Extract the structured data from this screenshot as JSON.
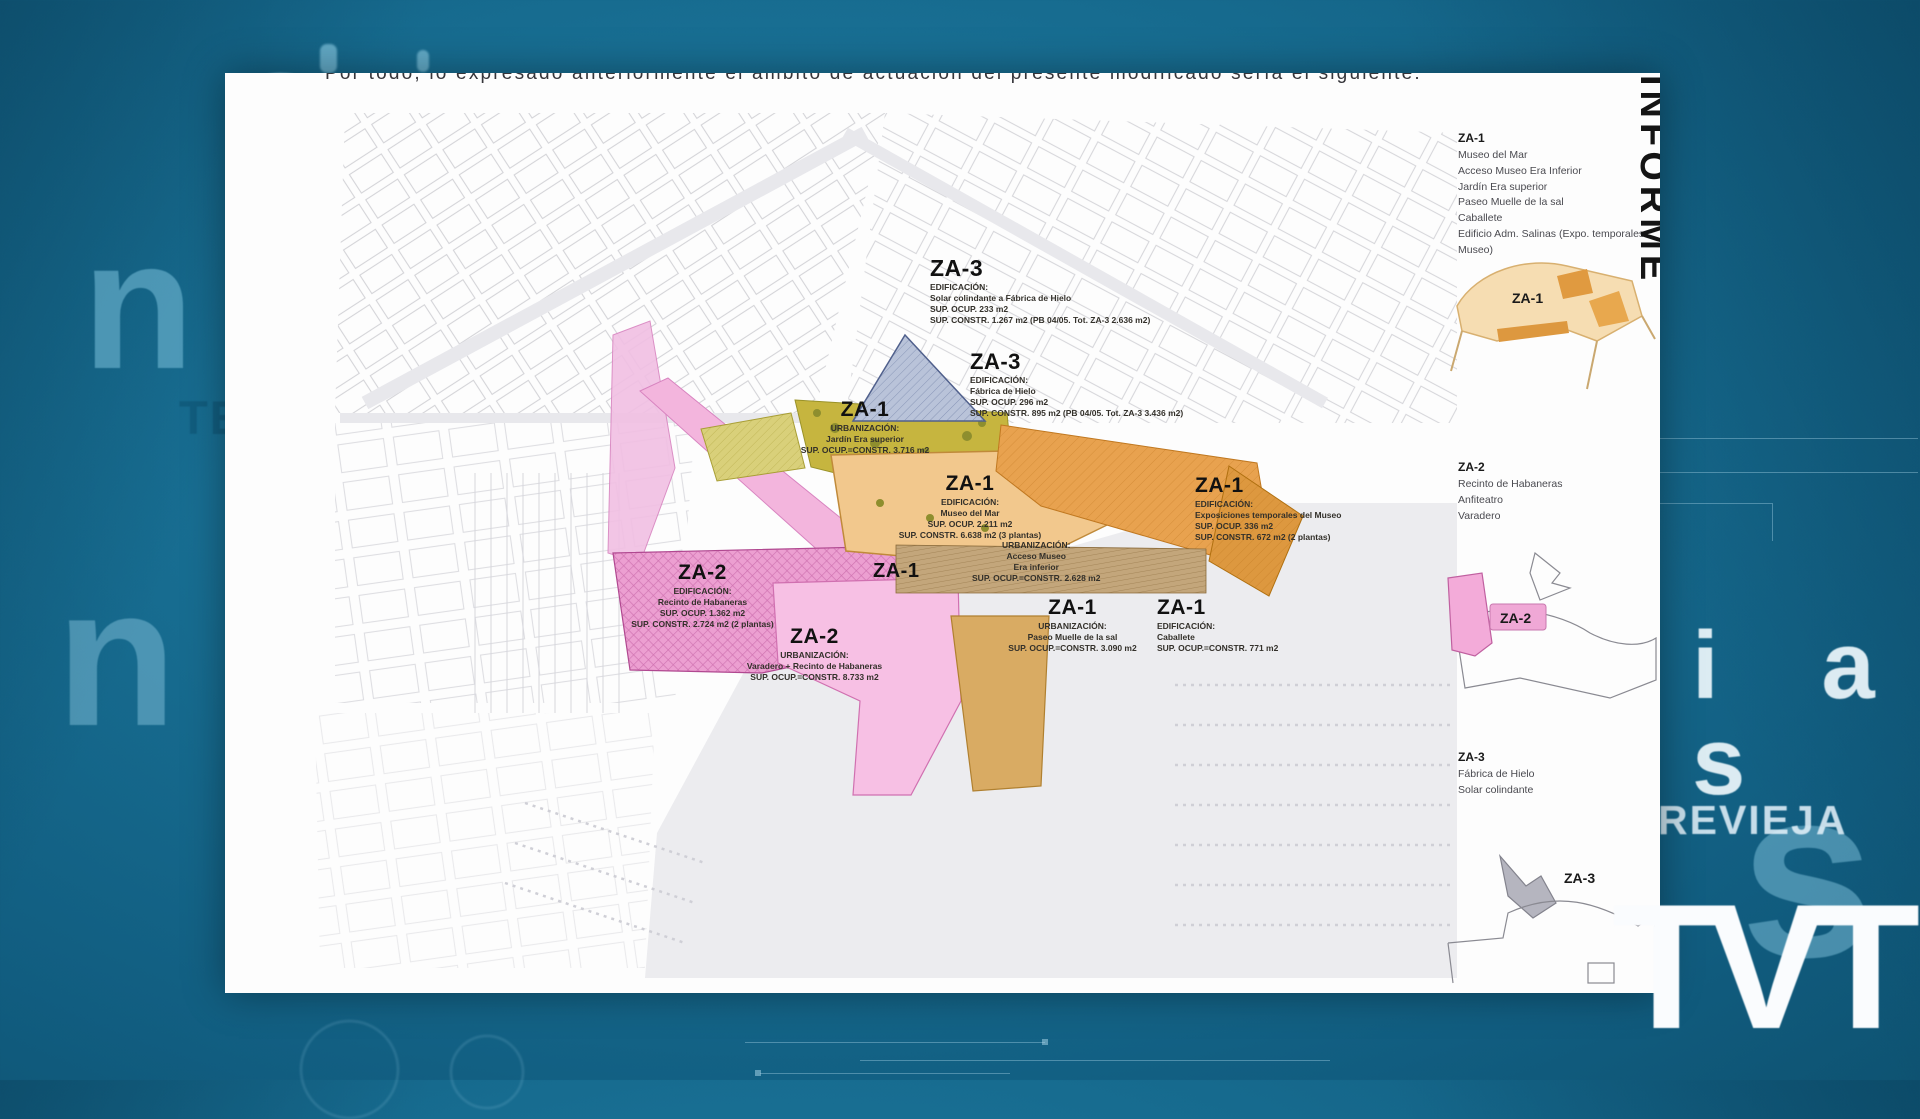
{
  "background": {
    "ghost_text": {
      "letter_o": "o",
      "letter_n_upper": "n",
      "letters_te": "TE",
      "letter_n_lower": "n",
      "letters_ias": "i a s",
      "word_revieja": "REVIEJA",
      "letter_s": "s"
    },
    "logo_text": "TVT",
    "colors": {
      "teal": "#176c90",
      "teal_dark": "#0e5372",
      "ghost_blue": "#80c0d8",
      "logo_white": "#fafcfe"
    }
  },
  "document": {
    "top_sentence": "Por todo, lo expresado anteriormente el ámbito de actuación del presente modificado sería el siguiente:",
    "vertical_label": "INFORME",
    "zone_colors": {
      "za1_tan": "#f2c88d",
      "za1_orange": "#e8a24f",
      "za2_pink": "#eda3d2",
      "za3_blue": "#b9c3d9",
      "olive_green": "#c6b53f"
    },
    "map_blocks": [
      {
        "zone": "ZA-3",
        "lines": [
          "EDIFICACIÓN:",
          "Solar colindante a Fábrica de Hielo",
          "SUP. OCUP. 233 m2",
          "SUP. CONSTR. 1.267 m2 (PB 04/05. Tot. ZA-3 2.636 m2)"
        ]
      },
      {
        "zone": "ZA-3",
        "lines": [
          "EDIFICACIÓN:",
          "Fábrica de Hielo",
          "SUP. OCUP. 296 m2",
          "SUP. CONSTR. 895 m2 (PB 04/05. Tot. ZA-3 3.436 m2)"
        ]
      },
      {
        "zone": "ZA-1",
        "lines": [
          "URBANIZACIÓN:",
          "Jardín Era superior",
          "SUP. OCUP.=CONSTR. 3.716 m2"
        ]
      },
      {
        "zone": "ZA-1",
        "lines": [
          "EDIFICACIÓN:",
          "Museo del Mar",
          "SUP. OCUP. 2.211 m2",
          "SUP. CONSTR. 6.638 m2 (3 plantas)"
        ]
      },
      {
        "zone": "ZA-1",
        "lines": [
          "URBANIZACIÓN:",
          "Acceso Museo",
          "Era inferior",
          "SUP. OCUP.=CONSTR. 2.628 m2"
        ]
      },
      {
        "zone": "ZA-1",
        "lines": [
          "EDIFICACIÓN:",
          "Exposiciones temporales del Museo",
          "SUP. OCUP. 336 m2",
          "SUP. CONSTR. 672 m2 (2 plantas)"
        ]
      },
      {
        "zone": "ZA-1",
        "lines": [
          "URBANIZACIÓN:",
          "Paseo Muelle de la sal",
          "SUP. OCUP.=CONSTR. 3.090 m2"
        ]
      },
      {
        "zone": "ZA-1",
        "lines": [
          "EDIFICACIÓN:",
          "Caballete",
          "SUP. OCUP.=CONSTR. 771 m2"
        ]
      },
      {
        "zone": "ZA-2",
        "lines": [
          "EDIFICACIÓN:",
          "Recinto de Habaneras",
          "SUP. OCUP. 1.362 m2",
          "SUP. CONSTR. 2.724 m2 (2 plantas)"
        ]
      },
      {
        "zone": "ZA-2",
        "lines": [
          "URBANIZACIÓN:",
          "Varadero + Recinto de Habaneras",
          "SUP. OCUP.=CONSTR. 8.733 m2"
        ]
      }
    ],
    "legend": {
      "za1": {
        "title": "ZA-1",
        "items": [
          "Museo del Mar",
          "Acceso Museo Era Inferior",
          "Jardín Era superior",
          "Paseo Muelle de la sal",
          "Caballete",
          "Edificio Adm. Salinas (Expo. temporales Museo)"
        ]
      },
      "za2": {
        "title": "ZA-2",
        "items": [
          "Recinto de Habaneras",
          "Anfiteatro",
          "Varadero"
        ]
      },
      "za3": {
        "title": "ZA-3",
        "items": [
          "Fábrica de Hielo",
          "Solar colindante"
        ]
      }
    },
    "minimaps": [
      {
        "label": "ZA-1"
      },
      {
        "label": "ZA-2"
      },
      {
        "label": "ZA-3"
      }
    ]
  }
}
